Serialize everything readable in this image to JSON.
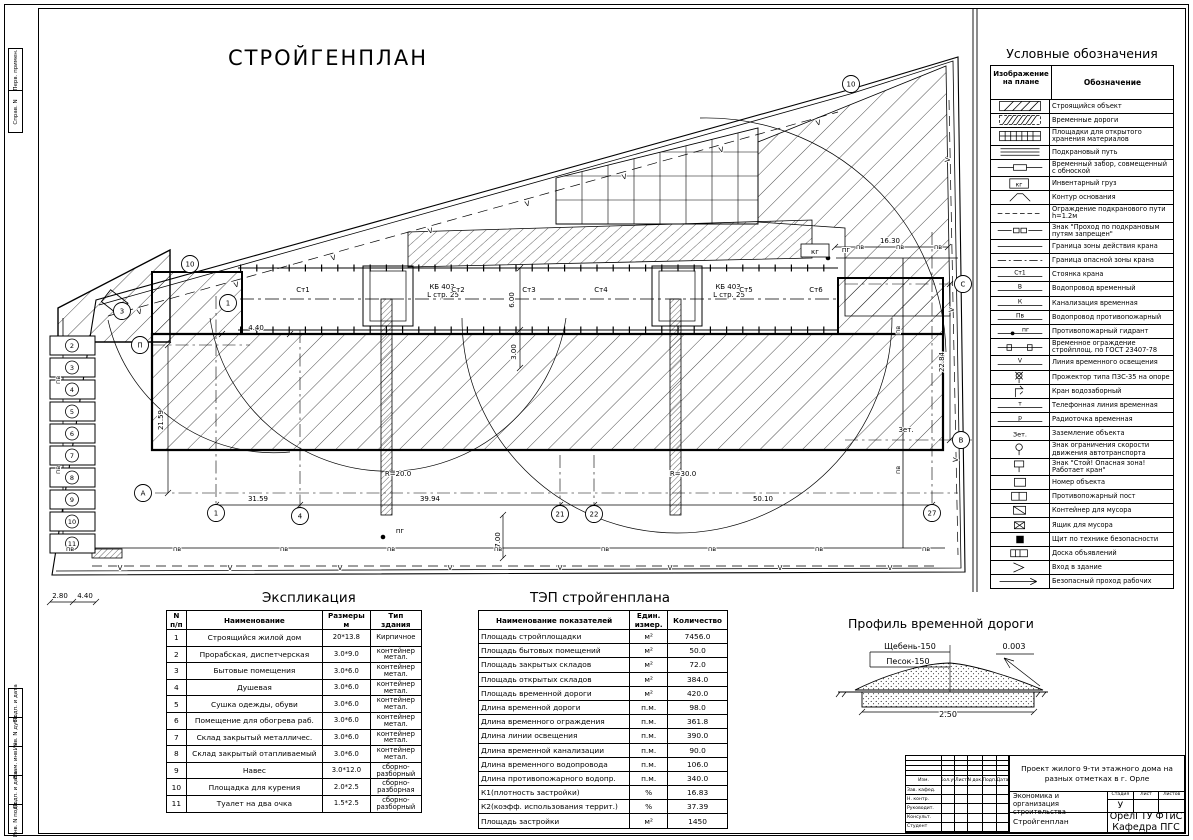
{
  "sheet": {
    "title": "СТРОЙГЕНПЛАН"
  },
  "legend": {
    "title": "Условные обозначения",
    "col_image": "Изображение на плане",
    "col_meaning": "Обозначение",
    "rows": [
      {
        "sym": "hatch",
        "label": "Строящийся объект"
      },
      {
        "sym": "hatch2",
        "label": "Временные дороги"
      },
      {
        "sym": "grid",
        "label": "Площадки для открытого хранения материалов"
      },
      {
        "sym": "rails",
        "label": "Подкрановый путь"
      },
      {
        "sym": "obnoska",
        "label": "Временный забор, совмещенный с обноской"
      },
      {
        "sym": "box:кг",
        "label": "Инвентарный груз"
      },
      {
        "sym": "arc",
        "label": "Контур основания"
      },
      {
        "sym": "dash",
        "label": "Ограждение подкранового пути h=1.2м"
      },
      {
        "sym": "sign2",
        "label": "Знак \"Проход по подкрановым путям запрещен\""
      },
      {
        "sym": "line",
        "label": "Граница зоны действия крана"
      },
      {
        "sym": "dashdot",
        "label": "Граница опасной зоны крана"
      },
      {
        "sym": "linelabel:Ст1",
        "label": "Стоянка крана"
      },
      {
        "sym": "linelabel:В",
        "label": "Водопровод временный"
      },
      {
        "sym": "linelabel:К",
        "label": "Канализация временная"
      },
      {
        "sym": "linelabel:Пв",
        "label": "Водопровод противопожарный"
      },
      {
        "sym": "linedot:пг",
        "label": "Противопожарный гидрант"
      },
      {
        "sym": "fence",
        "label": "Временное ограждение стройплощ. по ГОСТ 23407-78"
      },
      {
        "sym": "linelabel:V",
        "label": "Линия временного освещения"
      },
      {
        "sym": "projector",
        "label": "Прожектор типа ПЗС-35 на опоре"
      },
      {
        "sym": "tap",
        "label": "Кран водозаборный"
      },
      {
        "sym": "linelabel:т",
        "label": "Телефонная линия временная"
      },
      {
        "sym": "linelabel:р",
        "label": "Радиоточка временная"
      },
      {
        "sym": "text:Зет.",
        "label": "Заземление объекта"
      },
      {
        "sym": "speedsign",
        "label": "Знак ограничения скорости движения автотранспорта"
      },
      {
        "sym": "stopsign",
        "label": "Знак \"Стой! Опасная зона! Работает кран\""
      },
      {
        "sym": "numbox",
        "label": "Номер объекта"
      },
      {
        "sym": "post",
        "label": "Противопожарный пост"
      },
      {
        "sym": "container",
        "label": "Контейнер для мусора"
      },
      {
        "sym": "trash",
        "label": "Ящик для мусора"
      },
      {
        "sym": "shield",
        "label": "Щит по технике безопасности"
      },
      {
        "sym": "board",
        "label": "Доска объявлений"
      },
      {
        "sym": "entry",
        "label": "Вход в здание"
      },
      {
        "sym": "pass",
        "label": "Безопасный проход рабочих"
      }
    ]
  },
  "explication": {
    "title": "Экспликация",
    "headers": [
      "N п/п",
      "Наименование",
      "Размеры м",
      "Тип здания"
    ],
    "rows": [
      [
        "1",
        "Строящийся жилой дом",
        "20*13.8",
        "Кирпичное"
      ],
      [
        "2",
        "Прорабская, диспетчерская",
        "3.0*9.0",
        "контейнер метал."
      ],
      [
        "3",
        "Бытовые помещения",
        "3.0*6.0",
        "контейнер метал."
      ],
      [
        "4",
        "Душевая",
        "3.0*6.0",
        "контейнер метал."
      ],
      [
        "5",
        "Сушка одежды, обуви",
        "3.0*6.0",
        "контейнер метал."
      ],
      [
        "6",
        "Помещение для обогрева раб.",
        "3.0*6.0",
        "контейнер метал."
      ],
      [
        "7",
        "Склад закрытый металличес.",
        "3.0*6.0",
        "контейнер метал."
      ],
      [
        "8",
        "Склад закрытый отапливаемый",
        "3.0*6.0",
        "контейнер метал."
      ],
      [
        "9",
        "Навес",
        "3.0*12.0",
        "сборно-разборный"
      ],
      [
        "10",
        "Площадка для курения",
        "2.0*2.5",
        "сборно-разборная"
      ],
      [
        "11",
        "Туалет на два очка",
        "1.5*2.5",
        "сборно-разборный"
      ]
    ]
  },
  "tep": {
    "title": "ТЭП стройгенплана",
    "headers": [
      "Наименование показателей",
      "Един. измер.",
      "Количество"
    ],
    "rows": [
      [
        "Площадь стройплощадки",
        "м²",
        "7456.0"
      ],
      [
        "Площадь бытовых помещений",
        "м²",
        "50.0"
      ],
      [
        "Площадь закрытых складов",
        "м²",
        "72.0"
      ],
      [
        "Площадь открытых складов",
        "м²",
        "384.0"
      ],
      [
        "Площадь временной дороги",
        "м²",
        "420.0"
      ],
      [
        "Длина временной дороги",
        "п.м.",
        "98.0"
      ],
      [
        "Длина временного ограждения",
        "п.м.",
        "361.8"
      ],
      [
        "Длина линии освещения",
        "п.м.",
        "390.0"
      ],
      [
        "Длина временной канализации",
        "п.м.",
        "90.0"
      ],
      [
        "Длина временного водопровода",
        "п.м.",
        "106.0"
      ],
      [
        "Длина противопожарного водопр.",
        "п.м.",
        "340.0"
      ],
      [
        "К1(плотность застройки)",
        "%",
        "16.83"
      ],
      [
        "К2(коэфф. использования террит.)",
        "%",
        "37.39"
      ],
      [
        "Площадь застройки",
        "м²",
        "1450"
      ]
    ]
  },
  "profile": {
    "title": "Профиль временной дороги",
    "labels": [
      {
        "t": "Щебень-150",
        "x": 910,
        "y": 649
      },
      {
        "t": "Песок-150",
        "x": 908,
        "y": 664
      },
      {
        "t": "0.003",
        "x": 1014,
        "y": 649
      },
      {
        "t": "2.50",
        "x": 948,
        "y": 717
      }
    ]
  },
  "plan": {
    "water_mark": "пв",
    "light_mark": "V",
    "units": [
      "2",
      "3",
      "4",
      "5",
      "6",
      "7",
      "8",
      "9",
      "10",
      "11"
    ],
    "labels": [
      {
        "t": "4.40",
        "x": 256,
        "y": 330
      },
      {
        "t": "21.59",
        "x": 163,
        "y": 420,
        "r": -90
      },
      {
        "t": "31.59",
        "x": 258,
        "y": 501
      },
      {
        "t": "39.94",
        "x": 430,
        "y": 501
      },
      {
        "t": "50.10",
        "x": 763,
        "y": 501
      },
      {
        "t": "7.00",
        "x": 500,
        "y": 540,
        "r": -90
      },
      {
        "t": "R=20.0",
        "x": 398,
        "y": 476
      },
      {
        "t": "R=30.0",
        "x": 683,
        "y": 476
      },
      {
        "t": "16.30",
        "x": 890,
        "y": 243
      },
      {
        "t": "22.84",
        "x": 944,
        "y": 362,
        "r": -90
      },
      {
        "t": "6.00",
        "x": 514,
        "y": 300,
        "r": -90
      },
      {
        "t": "3.00",
        "x": 516,
        "y": 352,
        "r": -90
      },
      {
        "t": "2.80",
        "x": 60,
        "y": 598
      },
      {
        "t": "4.40",
        "x": 85,
        "y": 598
      },
      {
        "t": "Зет.",
        "x": 906,
        "y": 432
      },
      {
        "t": "КБ 403",
        "x": 442,
        "y": 289
      },
      {
        "t": "L стр. 25",
        "x": 443,
        "y": 297
      },
      {
        "t": "КБ 403",
        "x": 728,
        "y": 289
      },
      {
        "t": "L стр. 25",
        "x": 729,
        "y": 297
      },
      {
        "t": "Ст1",
        "x": 303,
        "y": 292
      },
      {
        "t": "Ст2",
        "x": 458,
        "y": 292
      },
      {
        "t": "Ст3",
        "x": 529,
        "y": 292
      },
      {
        "t": "Ст4",
        "x": 601,
        "y": 292
      },
      {
        "t": "Ст5",
        "x": 746,
        "y": 292
      },
      {
        "t": "Ст6",
        "x": 816,
        "y": 292
      },
      {
        "t": "пг",
        "x": 846,
        "y": 252
      },
      {
        "t": "пг",
        "x": 400,
        "y": 533
      },
      {
        "t": "кг",
        "x": 815,
        "y": 254
      }
    ],
    "axes": [
      {
        "t": "10",
        "x": 190,
        "y": 264
      },
      {
        "t": "10",
        "x": 851,
        "y": 84
      },
      {
        "t": "3",
        "x": 122,
        "y": 311
      },
      {
        "t": "1",
        "x": 228,
        "y": 303
      },
      {
        "t": "П",
        "x": 140,
        "y": 345
      },
      {
        "t": "А",
        "x": 143,
        "y": 493
      },
      {
        "t": "1",
        "x": 216,
        "y": 513
      },
      {
        "t": "4",
        "x": 300,
        "y": 516
      },
      {
        "t": "21",
        "x": 560,
        "y": 514
      },
      {
        "t": "22",
        "x": 594,
        "y": 514
      },
      {
        "t": "27",
        "x": 932,
        "y": 513
      },
      {
        "t": "С",
        "x": 963,
        "y": 284
      },
      {
        "t": "В",
        "x": 961,
        "y": 440
      }
    ]
  },
  "titleblock": {
    "project": "Проект жилого 9-ти этажного дома на разных отметках в г. Орле",
    "subject": "Экономика и организация строительства",
    "doc_name": "Стройгенплан",
    "stage_label": "Стадия",
    "list_label": "Лист",
    "lists_label": "Листов",
    "stage": "У",
    "org": "ОрелГТУ ФТиС Кафедра ПГС",
    "header_cols": [
      "Изм.",
      "Кол.уч",
      "Лист",
      "N док.",
      "Подп.",
      "Дата"
    ],
    "row_labels": [
      "Зав. кафед.",
      "Н. контр.",
      "Руководит.",
      "Консульт.",
      "Студент"
    ]
  },
  "frame": {
    "top_labels": [
      "Перв. примен.",
      "Справ. N"
    ],
    "bottom_labels": [
      "Подп. и дата",
      "Инв. N дубл.",
      "Взам. инв. N",
      "Подп. и дата",
      "Инв. N подл."
    ]
  }
}
